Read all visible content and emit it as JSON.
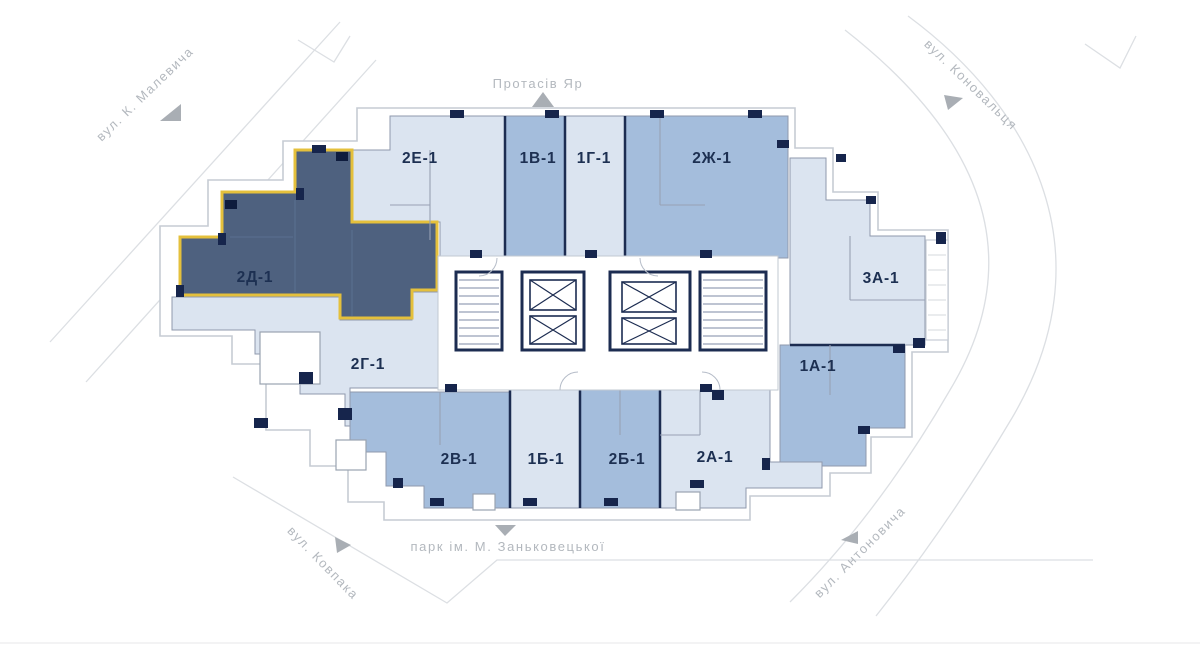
{
  "plan": {
    "type": "residential-floor-plan",
    "selected_apartment": "2Д-1"
  },
  "streets": {
    "malevycha": {
      "label": "вул. К. Малевича"
    },
    "protasiv": {
      "label": "Протасів Яр"
    },
    "konovaltsia": {
      "label": "вул. Коновальця"
    },
    "kovpaka": {
      "label": "вул. Ковпака"
    },
    "park": {
      "label": "парк ім. М. Заньковецької"
    },
    "antonovycha": {
      "label": "вул. Антоновича"
    }
  },
  "apartments": [
    {
      "id": "2d-1",
      "label": "2Д-1",
      "state": "selected"
    },
    {
      "id": "2e-1",
      "label": "2Е-1",
      "state": "light"
    },
    {
      "id": "1v-1",
      "label": "1В-1",
      "state": "medium"
    },
    {
      "id": "1g-1",
      "label": "1Г-1",
      "state": "light"
    },
    {
      "id": "2zh-1",
      "label": "2Ж-1",
      "state": "medium"
    },
    {
      "id": "3a-1",
      "label": "3А-1",
      "state": "light"
    },
    {
      "id": "1a-1",
      "label": "1А-1",
      "state": "medium"
    },
    {
      "id": "2g-1",
      "label": "2Г-1",
      "state": "light"
    },
    {
      "id": "2v-1",
      "label": "2В-1",
      "state": "medium"
    },
    {
      "id": "1b-1",
      "label": "1Б-1",
      "state": "light"
    },
    {
      "id": "2b-1",
      "label": "2Б-1",
      "state": "medium"
    },
    {
      "id": "2a-1",
      "label": "2А-1",
      "state": "light"
    }
  ],
  "colors": {
    "light": "#dbe4f0",
    "medium": "#a4bddc",
    "selected": "#4e617f",
    "selected_outline": "#e4c03c",
    "wall": "#1c2c51",
    "street_text": "#b3b8be",
    "street_line": "#dcdfe3"
  }
}
